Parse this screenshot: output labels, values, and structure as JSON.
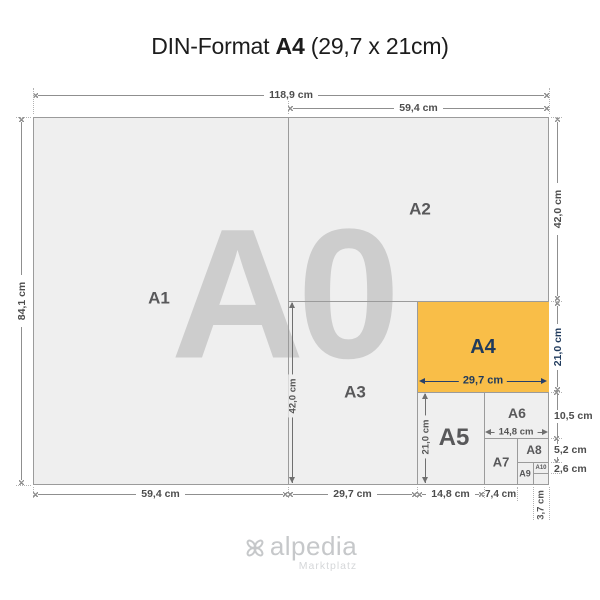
{
  "title": {
    "prefix": "DIN-Format",
    "highlight": "A4",
    "suffix": "(29,7 x 21cm)"
  },
  "colors": {
    "a4_fill": "#F9BE48",
    "a4_text": "#1F3A5C",
    "paper_fill": "#EFEFEF",
    "border_line": "#9B9B9B",
    "dim_line": "#8F8F8F",
    "dim_text": "#4D4D4D",
    "watermark": "#CDCDCD",
    "logo_gray": "#C6C8CA"
  },
  "formats": {
    "a0": "A0",
    "a1": "A1",
    "a2": "A2",
    "a3": "A3",
    "a4": "A4",
    "a5": "A5",
    "a6": "A6",
    "a7": "A7",
    "a8": "A8",
    "a9": "A9",
    "a10": "A10"
  },
  "dims": {
    "top_full": "118,9 cm",
    "top_right": "59,4 cm",
    "left": "84,1 cm",
    "right_a2": "42,0 cm",
    "right_a4": "21,0 cm",
    "right_a6": "10,5 cm",
    "right_a8": "5,2 cm",
    "right_a10": "2,6 cm",
    "bottom_a1": "59,4 cm",
    "bottom_a3": "29,7 cm",
    "bottom_a5": "14,8 cm",
    "bottom_a7": "7,4 cm",
    "bottom_a10": "3,7 cm",
    "inner_a3_height": "42,0 cm",
    "inner_a5_height": "21,0 cm",
    "inner_a4_width": "29,7 cm",
    "inner_a6_width": "14,8 cm"
  },
  "logo": {
    "name": "alpedia",
    "tagline": "Marktplatz"
  }
}
